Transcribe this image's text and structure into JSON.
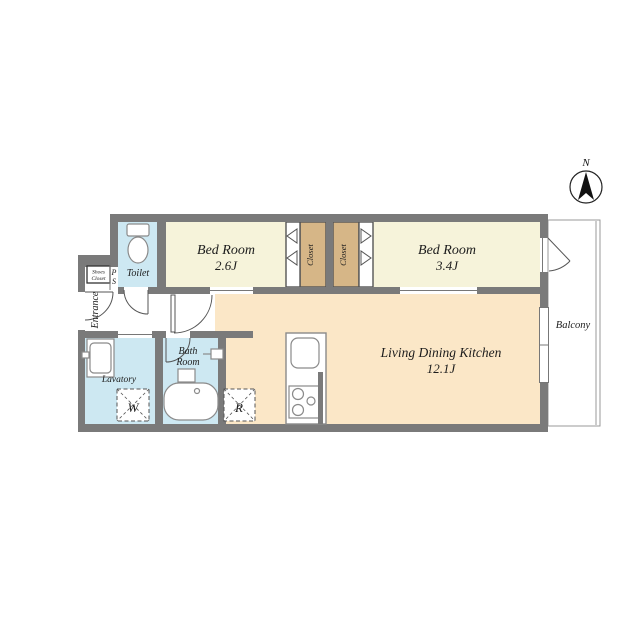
{
  "compass": {
    "north_label": "N"
  },
  "rooms": {
    "bedroom_small": {
      "name": "Bed Room",
      "size": "2.6J"
    },
    "bedroom_large": {
      "name": "Bed Room",
      "size": "3.4J"
    },
    "ldk": {
      "name": "Living Dining Kitchen",
      "size": "12.1J"
    },
    "closet_left": {
      "name": "Closet"
    },
    "closet_right": {
      "name": "Closet"
    },
    "toilet": {
      "name": "Toilet"
    },
    "bath": {
      "line1": "Bath",
      "line2": "Room"
    },
    "lavatory": {
      "name": "Lavatory"
    },
    "entrance": {
      "name": "Entrance"
    },
    "shoes_closet": {
      "line1": "Shoes",
      "line2": "Closet"
    },
    "pipe_space": {
      "line1": "P",
      "line2": "S"
    },
    "balcony": {
      "name": "Balcony"
    }
  },
  "appliance_marks": {
    "washer_label": "W",
    "refrigerator_label": "R"
  },
  "colors": {
    "wall": "#7a7a7a",
    "bedroom_floor": "#f6f3da",
    "closet_floor": "#d6b687",
    "ldk_floor": "#fbe7c7",
    "wet_area_floor": "#cde8f2",
    "white_floor": "#ffffff",
    "door_line": "#555555",
    "fixture_stroke": "#8a8a8a",
    "text": "#1c1c1c"
  }
}
